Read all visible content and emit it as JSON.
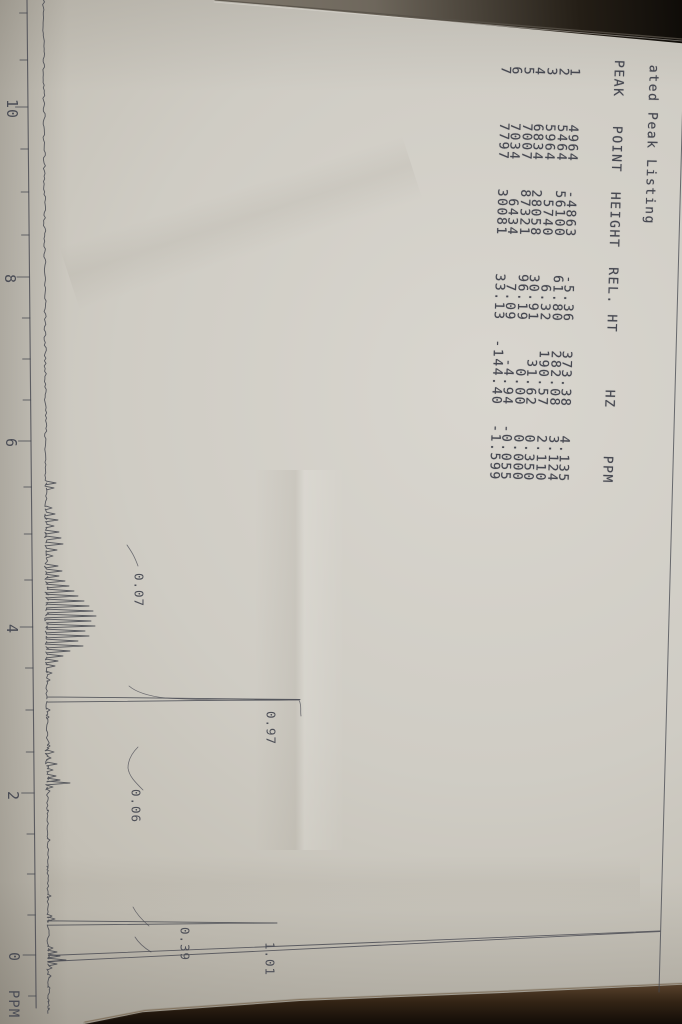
{
  "listing": {
    "title": "ated Peak Listing",
    "header": "PEAK   POINT  HEIGHT  REL. HT      HZ     PPM"
  },
  "axis": {
    "tick_labels": [
      "10",
      "8",
      "6",
      "4",
      "2",
      "0"
    ],
    "unit": "PPM"
  },
  "integration_labels": [
    "0.07",
    "0.97",
    "0.06",
    "0.39",
    "1.01"
  ],
  "chart_data": {
    "type": "line",
    "title": "ated Peak Listing",
    "description": "1H NMR spectrum printout photographed rotated 90 degrees clockwise; ppm axis runs top (10) to bottom (0), peak intensity extends rightward",
    "xlabel": "PPM",
    "xlim": [
      11,
      -0.6
    ],
    "x_ticks": [
      10,
      8,
      6,
      4,
      2,
      0
    ],
    "grid": false,
    "peak_table": {
      "columns": [
        "PEAK",
        "POINT",
        "HEIGHT",
        "REL. HT",
        "HZ",
        "PPM"
      ],
      "rows": [
        [
          "1",
          "4964",
          "-4863",
          "-5.36",
          "373.38",
          "4.135"
        ],
        [
          "2",
          "5464",
          "56100",
          "61.80",
          "282.08",
          "3.124"
        ],
        [
          "3",
          "5964",
          "5740",
          "6.32",
          "190.57",
          "2.110"
        ],
        [
          "4",
          "6834",
          "28058",
          "30.91",
          "31.62",
          "0.350"
        ],
        [
          "5",
          "7007",
          "87321",
          "96.19",
          "0.00",
          "0.000"
        ],
        [
          "6",
          "7034",
          "6434",
          "7.09",
          "-4.94",
          "-0.055"
        ],
        [
          "7",
          "7797",
          "30081",
          "33.13",
          "-144.40",
          "-1.599"
        ]
      ]
    },
    "integrations": [
      {
        "ppm": 4.135,
        "value": "0.07"
      },
      {
        "ppm": 3.124,
        "value": "0.97"
      },
      {
        "ppm": 2.11,
        "value": "0.06"
      },
      {
        "ppm": 0.35,
        "value": "0.39"
      },
      {
        "ppm": 0.0,
        "value": "1.01"
      }
    ]
  }
}
